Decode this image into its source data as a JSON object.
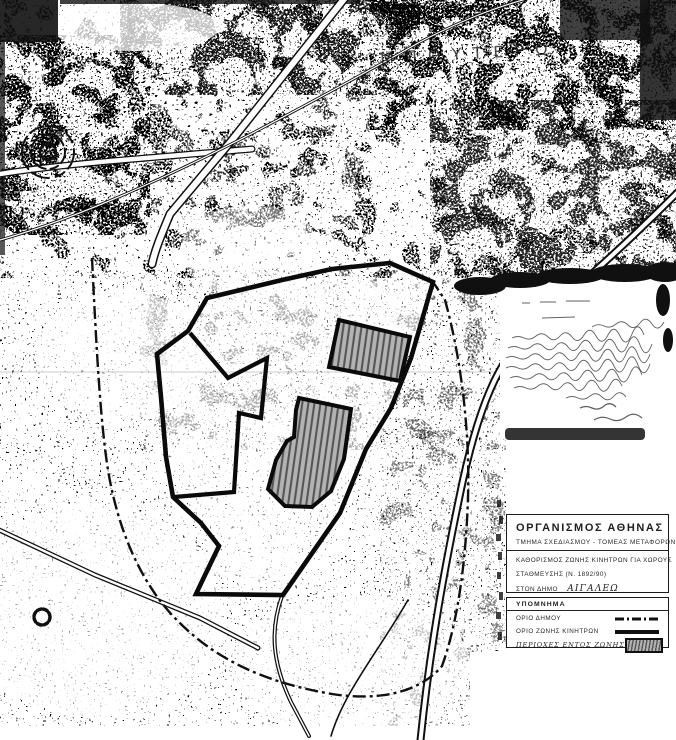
{
  "map": {
    "area_label": "Μ Π Ο Υ Τ Ε Ρ Ω",
    "features": {
      "municipal_boundary": "dash-dot boundary line",
      "incentive_zone_boundary": "thick solid boundary line",
      "zone_areas": "hatched polygons inside zone",
      "handwritten_note": "illegible handwritten certification note with signature"
    }
  },
  "title_block": {
    "org": "ΟΡΓΑΝΙΣΜΟΣ  ΑΘΗΝΑΣ",
    "dept": "ΤΜΗΜΑ  ΣΧΕΔΙΑΣΜΟΥ  -  ΤΟΜΕΑΣ  ΜΕΤΑΦΟΡΩΝ",
    "subject_line1": "ΚΑΘΟΡΙΣΜΟΣ  ΖΩΝΗΣ  ΚΙΝΗΤΡΩΝ  ΓΙΑ  ΧΩΡΟΥΣ",
    "subject_line2": "ΣΤΑΘΜΕΥΣΗΣ  (Ν. 1892/90)",
    "subject_line3_prefix": "ΣΤΟΝ  ΔΗΜΟ",
    "municipality": "ΑΙΓΑΛΕΩ"
  },
  "legend": {
    "header": "ΥΠΟΜΝΗΜΑ",
    "items": [
      {
        "label": "ΟΡΙΟ ΔΗΜΟΥ",
        "symbol": "dash-dot-line"
      },
      {
        "label": "ΟΡΙΟ ΖΩΝΗΣ ΚΙΝΗΤΡΩΝ",
        "symbol": "solid-thick-line"
      },
      {
        "label": "ΠΕΡΙΟΧΕΣ ΕΝΤΟΣ ΖΩΝΗΣ",
        "symbol": "hatched-rectangle"
      }
    ]
  },
  "colors": {
    "ink": "#101010",
    "paper": "#ffffff",
    "hatch_fill": "#b3b3b3",
    "hatch_line": "#565656"
  }
}
